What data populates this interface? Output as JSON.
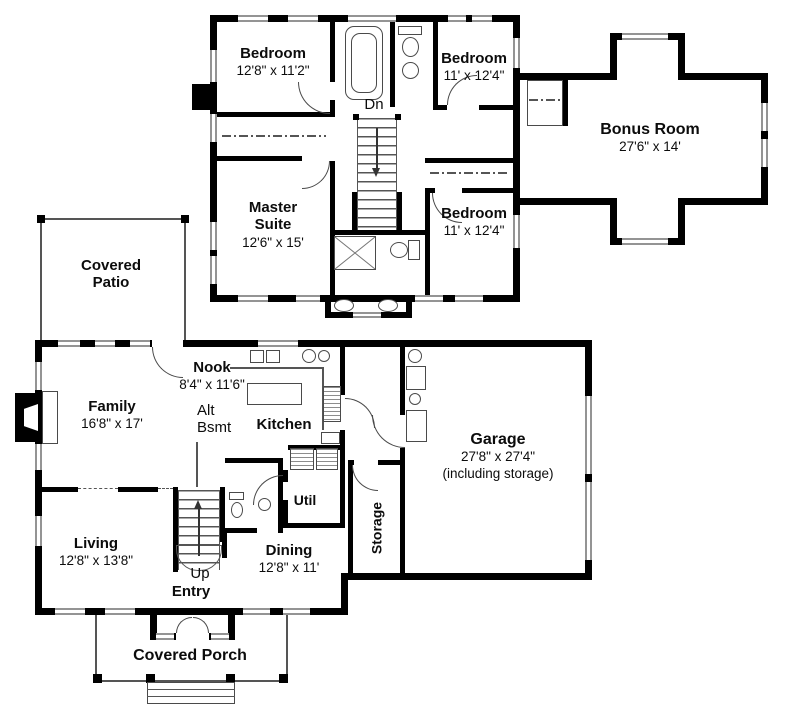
{
  "colors": {
    "wall": "#000000",
    "line": "#4a4a4a",
    "window_line": "#949494",
    "background": "#ffffff"
  },
  "upper_floor": {
    "bedroom1": {
      "name": "Bedroom",
      "dims": "12'8\" x 11'2\""
    },
    "bedroom2": {
      "name": "Bedroom",
      "dims": "11' x 12'4\""
    },
    "master_suite": {
      "name_line1": "Master",
      "name_line2": "Suite",
      "dims": "12'6\" x 15'"
    },
    "bedroom3": {
      "name": "Bedroom",
      "dims": "11' x 12'4\""
    },
    "bonus_room": {
      "name": "Bonus Room",
      "dims": "27'6\" x 14'"
    },
    "stairs": {
      "label": "Dn"
    }
  },
  "main_floor": {
    "covered_patio": {
      "name_line1": "Covered",
      "name_line2": "Patio"
    },
    "family": {
      "name": "Family",
      "dims": "16'8\" x 17'"
    },
    "nook": {
      "name": "Nook",
      "dims": "8'4\" x 11'6\""
    },
    "alt_bsmt": {
      "line1": "Alt",
      "line2": "Bsmt"
    },
    "kitchen": {
      "name": "Kitchen"
    },
    "garage": {
      "name": "Garage",
      "dims": "27'8\" x 27'4\"",
      "note": "(including storage)"
    },
    "living": {
      "name": "Living",
      "dims": "12'8\" x 13'8\""
    },
    "stairs": {
      "label": "Up"
    },
    "entry": {
      "name": "Entry"
    },
    "dining": {
      "name": "Dining",
      "dims": "12'8\" x 11'"
    },
    "util": {
      "name": "Util"
    },
    "storage": {
      "name": "Storage"
    },
    "covered_porch": {
      "name": "Covered Porch"
    }
  }
}
